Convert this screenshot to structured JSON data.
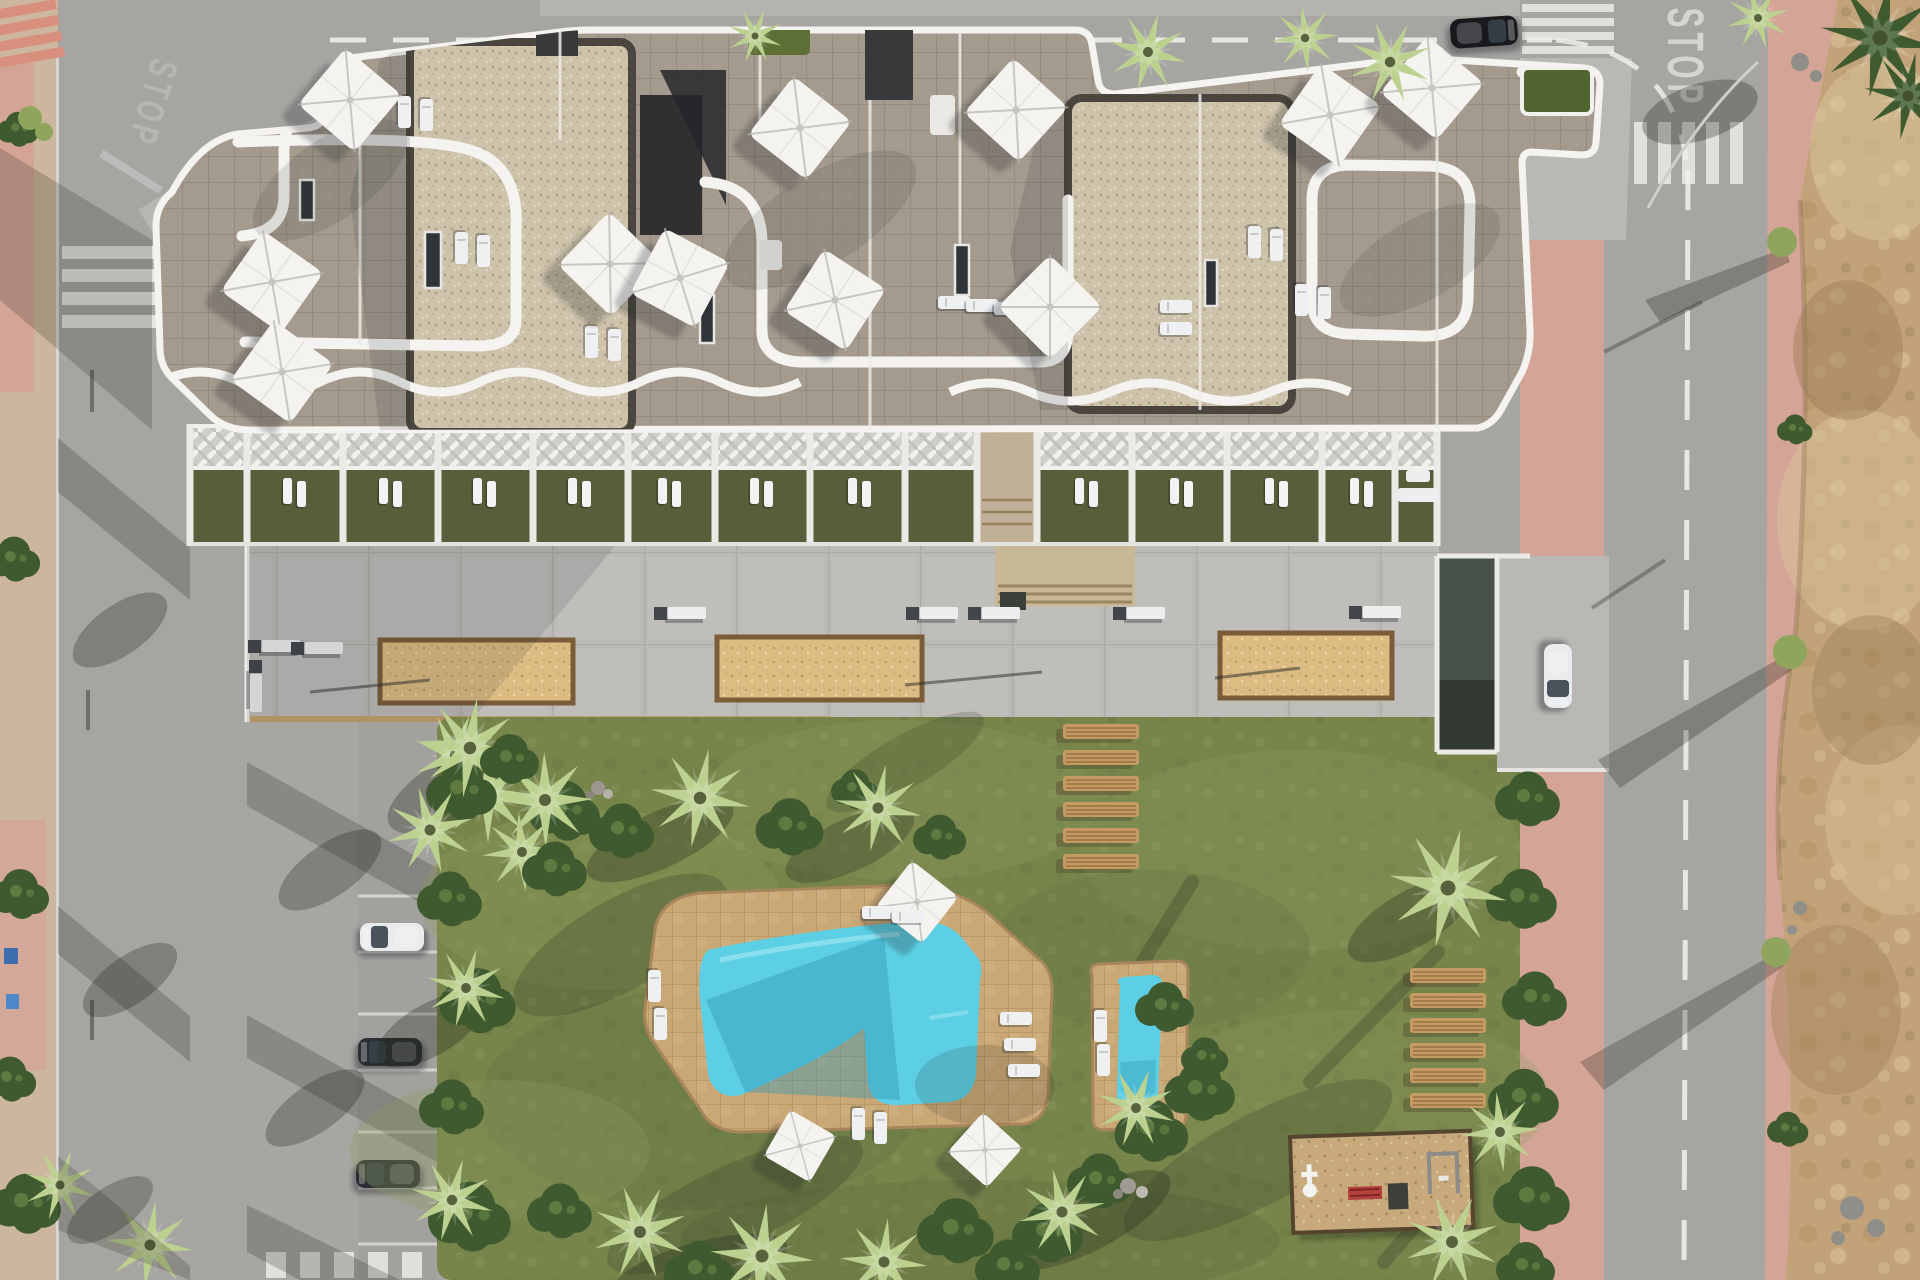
{
  "scene": {
    "type": "aerial-architectural-render",
    "description": "Top-down 3D render of a white residential apartment complex with rooftop terraces and parasols, ground-floor garden terraces, a concrete plaza with three petanque sand courts, a large communal garden with a free-form swimming pool and a separate children's pool, wooden sunbathing decks, a playground, street parking with cars, and surrounding roads beside an undeveloped dirt plot."
  },
  "road_markings": {
    "stop_text": "STOP",
    "stop_text_faint": "STOP"
  },
  "inventory": {
    "rooftop_parasols": 11,
    "pool_parasols": 3,
    "petanque_courts": 3,
    "plaza_benches": 8,
    "wooden_deck_planks_group_a": 6,
    "wooden_deck_planks_group_b": 6,
    "pools": 2,
    "parked_cars_street": 3,
    "car_on_road": 1,
    "car_at_garage_ramp": 1,
    "playgrounds": 1,
    "ground_floor_terraces": 12
  },
  "palette": {
    "road": "#a7a5a2",
    "roadLight": "#b5b3af",
    "pavement": "#bab8b4",
    "sidewalkPink": "#d4a596",
    "sidewalkTan": "#cdb69e",
    "concrete": "#bcbab6",
    "stone": "#a49a8e",
    "gravel": "#cdc2aa",
    "roofDark": "#39393b",
    "structureWhite": "#f4f3f0",
    "terraceLawn": "#565f39",
    "grass": "#77854b",
    "poolDeck": "#c9a876",
    "poolWater": "#5ccfe4",
    "poolWaterDeep": "#2f93b4",
    "sandCourt": "#dcbc82",
    "dirt": "#c2a379",
    "woodBench": "#c69b63",
    "carWhite": "#e9ebed",
    "carDark": "#2b2e33",
    "carBlack": "#17191d",
    "palmLight": "#bcd08f",
    "palmMid": "#8fa55e",
    "bushDark": "#3e5a2e"
  }
}
